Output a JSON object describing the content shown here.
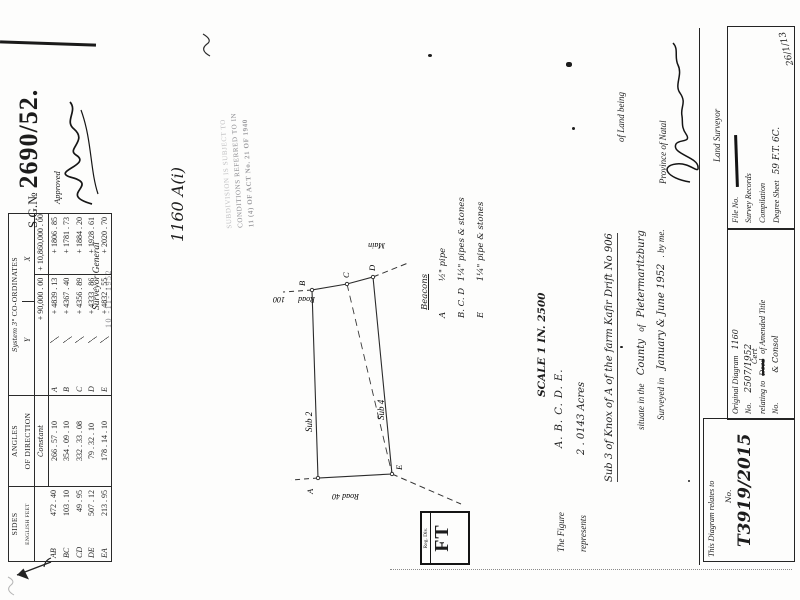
{
  "sg": {
    "label": "S.G.№",
    "number": "2690/52."
  },
  "approval": {
    "approved": "Approved",
    "title": "Surveyor  General",
    "date_stamp": "10 -11- 1952"
  },
  "act_stamp": {
    "line1": "SUBDIVISION IS SUBJECT TO",
    "line2": "CONDITIONS REFERRED TO IN",
    "line3": "11 (4) OF ACT No. 21 OF 1940"
  },
  "diagram_ref": "1160 A(i)",
  "table": {
    "headers": {
      "sides": "SIDES",
      "sides_sub": "ENGLISH FEET",
      "angles": "ANGLES",
      "angles_sub": "OF DIRECTION",
      "system": "System 3°",
      "coordinates": "CO-ORDINATES",
      "y": "Y",
      "x": "X",
      "constant": "Constant"
    },
    "constant_row": {
      "y": "+ 90,000 . 00",
      "x": "+ 10,860,000 . 00"
    },
    "rows": [
      {
        "side": "AB",
        "length": "472 . 40",
        "angle": "266 . 57 . 10",
        "pt": "A",
        "y": "+ 4839 . 13",
        "x": "+ 1806 . 85"
      },
      {
        "side": "BC",
        "length": "103 . 10",
        "angle": "354 . 09 . 10",
        "pt": "B",
        "y": "+ 4367 . 40",
        "x": "+ 1781 . 73"
      },
      {
        "side": "CD",
        "length": "49 . 95",
        "angle": "332 . 33 . 08",
        "pt": "C",
        "y": "+ 4356 . 89",
        "x": "+ 1884 . 20"
      },
      {
        "side": "DE",
        "length": "507 . 12",
        "angle": "79 . 32 . 10",
        "pt": "D",
        "y": "+ 4333 . 86",
        "x": "+ 1928 . 61"
      },
      {
        "side": "EA",
        "length": "213 . 95",
        "angle": "178 . 14 . 10",
        "pt": "E",
        "y": "+ 4832 . 55",
        "x": "+ 2020 . 70"
      }
    ]
  },
  "plot": {
    "main_road_word1": "Main",
    "main_road_word2": "Road",
    "main_road_width": "100",
    "road40": "Road 40",
    "sub2": "Sub 2",
    "sub4": "Sub 4",
    "beacon_a": "A",
    "beacon_b": "B",
    "beacon_c": "C",
    "beacon_d": "D",
    "beacon_e": "E"
  },
  "legend": {
    "title": "Beacons",
    "items": [
      {
        "k": "A",
        "v": "½\" pipe"
      },
      {
        "k": "B. C. D",
        "v": "1¼\" pipes & stones"
      },
      {
        "k": "E",
        "v": "1¼\" pipe & stones"
      }
    ]
  },
  "scale": "SCALE 1 IN. 2500",
  "figure": {
    "l1_print": "The Figure",
    "l1_hand": "A. B. C. D. E.",
    "l2_print": "represents",
    "l2_hand": "2 . 0143  Acres",
    "l2_right": "of Land being",
    "l3_hand": "Sub    3    of  Knox of A  of the farm  Kafir Drift    No 906",
    "l4_print": "situate in the",
    "l4_hand1": "County",
    "l4_of": "of",
    "l4_hand2": "Pietermaritzburg",
    "l4_right": "Province of Natal",
    "l5_print1": "Surveyed in",
    "l5_hand": "January   & June   1952",
    "l5_print2": ".  by me."
  },
  "surveyor": {
    "title": "Land Surveyor"
  },
  "panels": {
    "left": {
      "heading": "This Diagram relates to",
      "no_label": "No.",
      "number": "T3919/2015"
    },
    "middle": {
      "l1_print": "Original Diagram",
      "l1_hand": "1160",
      "l2_label": "No.",
      "l2_hand": "2507/1952",
      "l3_pre": "relating to",
      "l3_struck": "Deed",
      "l3_over": "Cert",
      "l3_post": "of  Amended Title",
      "l4_label": "No.",
      "l4_hand": "& Consol"
    },
    "right": {
      "file": "File No.",
      "records": "Survey Records",
      "compilation": "Compilation",
      "degree": "Degree Sheet",
      "degree_hand": "59 F.T. 6C.",
      "date_note": "26/1/13"
    }
  },
  "reg_stamp": {
    "top": "Reg. Div.",
    "big": "FT"
  }
}
